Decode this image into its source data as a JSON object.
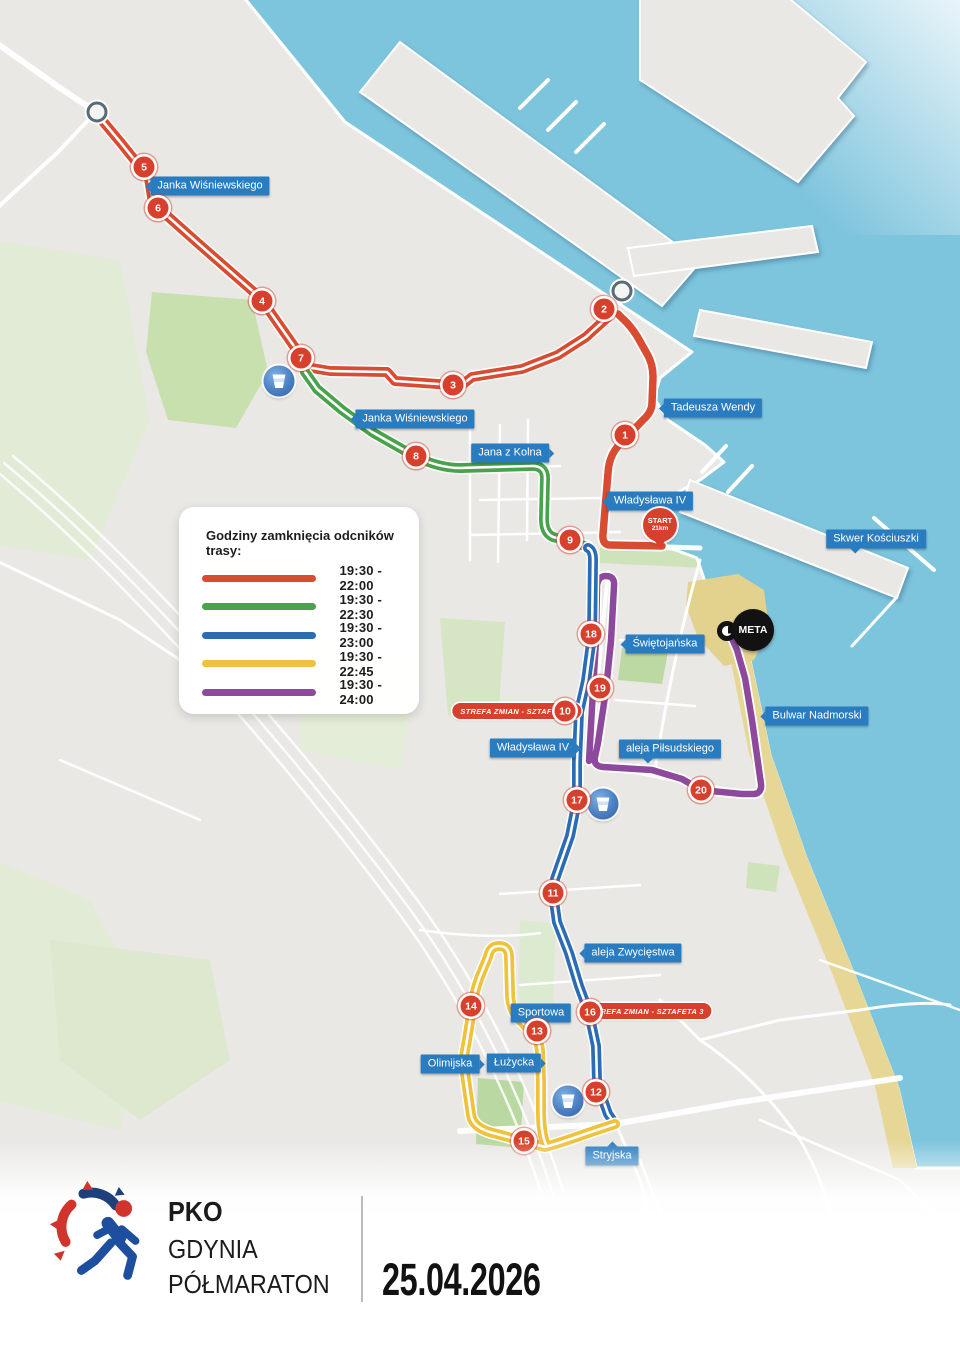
{
  "event": {
    "brand": "PKO",
    "city": "GDYNIA",
    "race": "PÓŁMARATON",
    "date": "25.04.2026"
  },
  "legend": {
    "title": "Godziny zamknięcia odcników trasy:",
    "items": [
      {
        "color": "#d84c31",
        "time": "19:30 - 22:00"
      },
      {
        "color": "#49a24c",
        "time": "19:30 - 22:30"
      },
      {
        "color": "#2c6cb5",
        "time": "19:30 - 23:00"
      },
      {
        "color": "#eec23c",
        "time": "19:30 - 22:45"
      },
      {
        "color": "#8d4a9d",
        "time": "19:30 - 24:00"
      }
    ]
  },
  "map": {
    "street_labels": [
      {
        "text": "Janka Wiśniewskiego",
        "x": 210,
        "y": 186,
        "tail": "left"
      },
      {
        "text": "Janka Wiśniewskiego",
        "x": 415,
        "y": 419,
        "tail": "left"
      },
      {
        "text": "Jana z Kolna",
        "x": 510,
        "y": 453,
        "tail": "right"
      },
      {
        "text": "Tadeusza Wendy",
        "x": 713,
        "y": 408,
        "tail": "left"
      },
      {
        "text": "Władysława IV",
        "x": 650,
        "y": 501,
        "tail": "left"
      },
      {
        "text": "Skwer Kościuszki",
        "x": 876,
        "y": 539,
        "tail": "down"
      },
      {
        "text": "Świętojańska",
        "x": 665,
        "y": 644,
        "tail": "left"
      },
      {
        "text": "Władysława IV",
        "x": 533,
        "y": 748,
        "tail": "right"
      },
      {
        "text": "aleja Piłsudskiego",
        "x": 670,
        "y": 749,
        "tail": "down"
      },
      {
        "text": "Bulwar Nadmorski",
        "x": 817,
        "y": 716,
        "tail": "left"
      },
      {
        "text": "aleja Zwycięstwa",
        "x": 633,
        "y": 953,
        "tail": "left"
      },
      {
        "text": "Sportowa",
        "x": 541,
        "y": 1013,
        "tail": "down"
      },
      {
        "text": "Olimijska",
        "x": 450,
        "y": 1064,
        "tail": "right"
      },
      {
        "text": "Łużycka",
        "x": 514,
        "y": 1063,
        "tail": "right"
      },
      {
        "text": "Stryjska",
        "x": 612,
        "y": 1156,
        "tail": "up"
      }
    ],
    "km_markers": [
      {
        "n": 1,
        "x": 625,
        "y": 435
      },
      {
        "n": 2,
        "x": 604,
        "y": 309
      },
      {
        "n": 3,
        "x": 453,
        "y": 385
      },
      {
        "n": 4,
        "x": 262,
        "y": 301
      },
      {
        "n": 5,
        "x": 144,
        "y": 167
      },
      {
        "n": 6,
        "x": 158,
        "y": 208
      },
      {
        "n": 7,
        "x": 301,
        "y": 358
      },
      {
        "n": 8,
        "x": 416,
        "y": 456
      },
      {
        "n": 9,
        "x": 570,
        "y": 540
      },
      {
        "n": 10,
        "x": 565,
        "y": 711
      },
      {
        "n": 11,
        "x": 553,
        "y": 893
      },
      {
        "n": 12,
        "x": 596,
        "y": 1092
      },
      {
        "n": 13,
        "x": 537,
        "y": 1031
      },
      {
        "n": 14,
        "x": 471,
        "y": 1006
      },
      {
        "n": 15,
        "x": 524,
        "y": 1141
      },
      {
        "n": 16,
        "x": 590,
        "y": 1012
      },
      {
        "n": 17,
        "x": 577,
        "y": 800
      },
      {
        "n": 18,
        "x": 591,
        "y": 634
      },
      {
        "n": 19,
        "x": 600,
        "y": 688
      },
      {
        "n": 20,
        "x": 701,
        "y": 790
      }
    ],
    "relay_zones": [
      {
        "text": "STREFA ZMIAN - SZTAFETA 2",
        "x": 517,
        "y": 711
      },
      {
        "text": "STREFA ZMIAN - SZTAFETA 3",
        "x": 647,
        "y": 1011
      }
    ],
    "water_points": [
      {
        "x": 279,
        "y": 381
      },
      {
        "x": 603,
        "y": 804
      },
      {
        "x": 568,
        "y": 1101
      }
    ],
    "turnarounds": [
      {
        "x": 97,
        "y": 112
      },
      {
        "x": 622,
        "y": 291
      }
    ],
    "start": {
      "label": "START",
      "sublabel": "21km",
      "x": 660,
      "y": 548
    },
    "meta": {
      "label": "META",
      "x": 753,
      "y": 630
    }
  },
  "colors": {
    "water": "#7dc4dd",
    "land": "#e9e8e5",
    "sand": "#e6d796",
    "route_red": "#d84c31",
    "route_green": "#49a24c",
    "route_blue": "#2c6cb5",
    "route_yellow": "#eec23c",
    "route_purple": "#8d4a9d",
    "street_label": "#2a7cc0",
    "marker": "#d7402c"
  }
}
